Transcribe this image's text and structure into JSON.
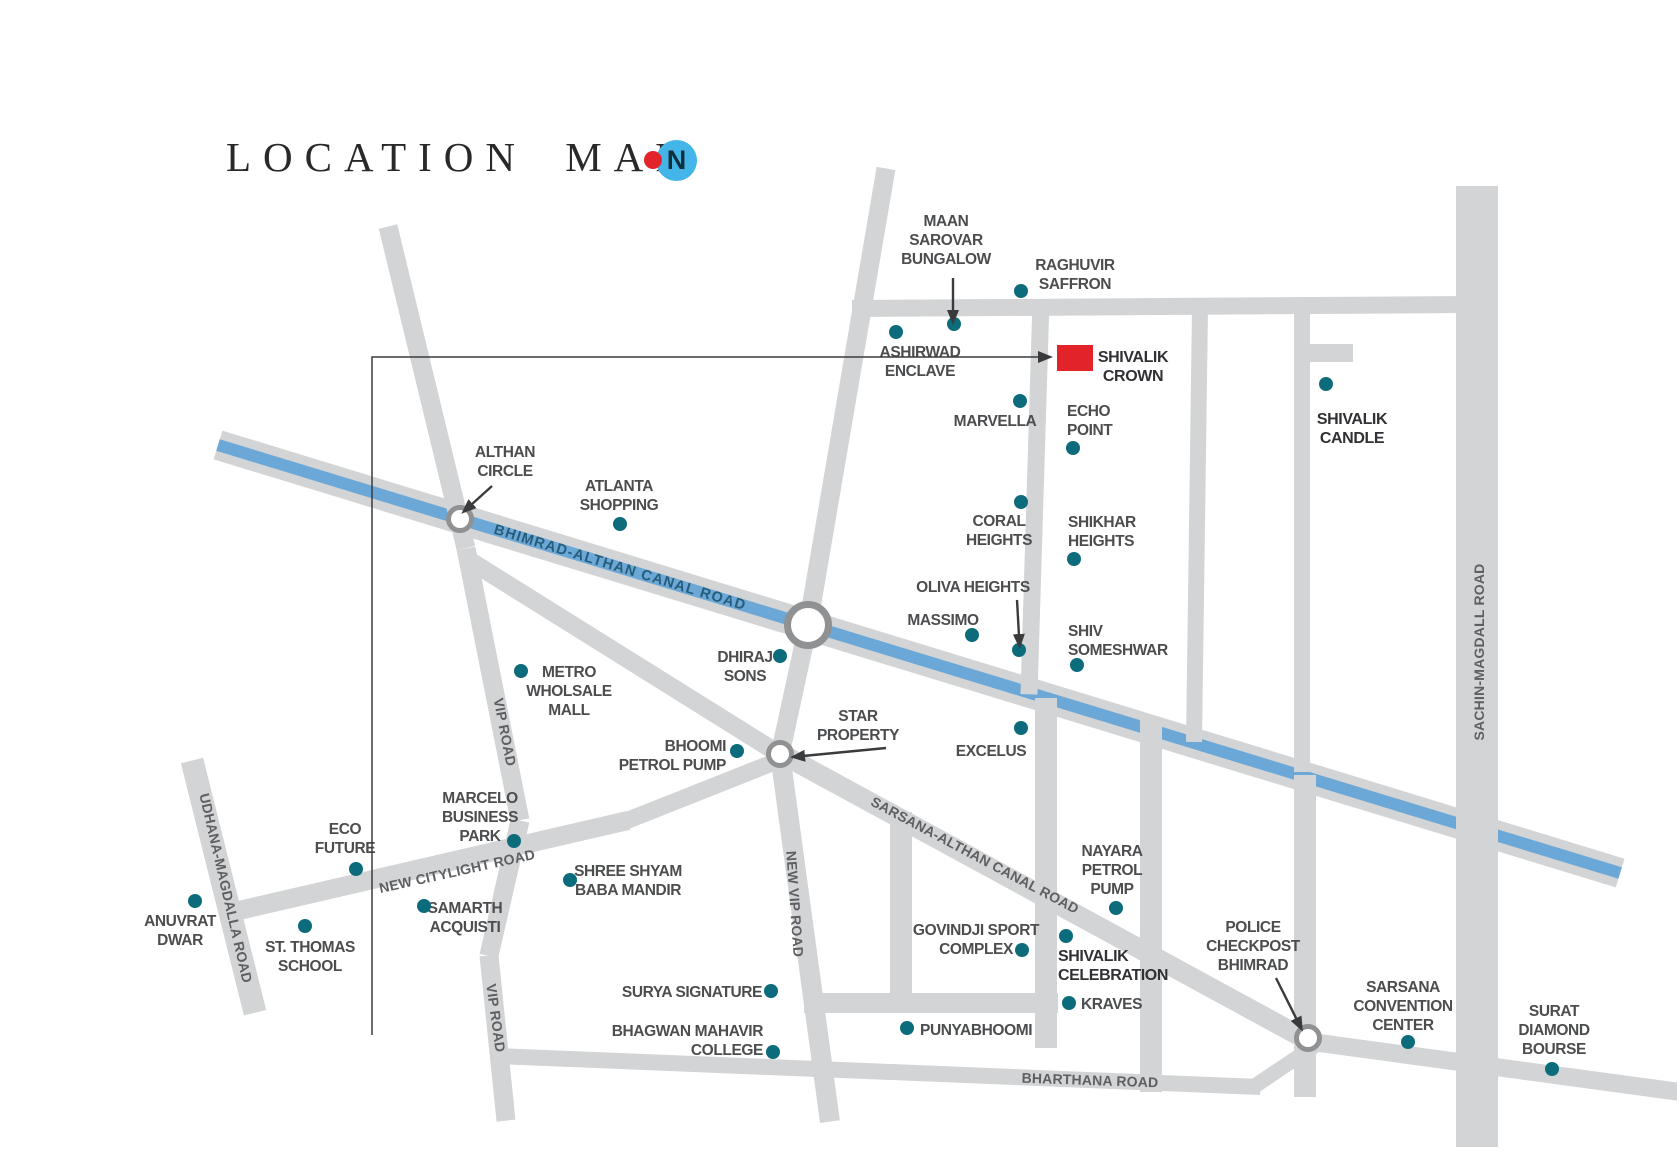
{
  "title": {
    "text": "LOCATION MAP"
  },
  "compass": {
    "letter": "N"
  },
  "colors": {
    "road": "#d3d4d5",
    "canal_blue": "#6ba8d7",
    "ring": "#8f9193",
    "dot": "#0d6c7c",
    "red": "#e3232a",
    "place_text": "#4c4d4f",
    "bold_text": "#303134",
    "road_text": "#5e5f62",
    "canal_text": "#275d7b",
    "arrow": "#3a3b3d",
    "compass_circle": "#44b5e9",
    "compass_letter": "#0e2f3c"
  },
  "map": {
    "canal": {
      "name": "bhimrad-althan-canal",
      "x1": 218,
      "y1": 445,
      "x2": 1620,
      "y2": 873,
      "w": 30
    },
    "roads": [
      {
        "name": "top-road",
        "x1": 852,
        "y1": 308,
        "x2": 1472,
        "y2": 304,
        "w": 17
      },
      {
        "name": "north-approach",
        "x1": 886,
        "y1": 168,
        "x2": 808,
        "y2": 625,
        "w": 19
      },
      {
        "name": "mid-link",
        "x1": 808,
        "y1": 625,
        "x2": 780,
        "y2": 754,
        "w": 19
      },
      {
        "name": "new-vip-road",
        "x1": 780,
        "y1": 754,
        "x2": 830,
        "y2": 1122,
        "w": 20
      },
      {
        "name": "vip-road-upper",
        "x1": 388,
        "y1": 226,
        "x2": 466,
        "y2": 548,
        "w": 19
      },
      {
        "name": "vip-road-mid",
        "x1": 466,
        "y1": 548,
        "x2": 520,
        "y2": 820,
        "w": 19
      },
      {
        "name": "vip-road-lower",
        "x1": 520,
        "y1": 820,
        "x2": 489,
        "y2": 955,
        "w": 19
      },
      {
        "name": "vip-road-end",
        "x1": 489,
        "y1": 955,
        "x2": 506,
        "y2": 1120,
        "w": 19
      },
      {
        "name": "star-branch",
        "x1": 472,
        "y1": 562,
        "x2": 792,
        "y2": 762,
        "w": 18
      },
      {
        "name": "sarsana-althan-canal-road",
        "x1": 778,
        "y1": 752,
        "x2": 1318,
        "y2": 1046,
        "w": 20
      },
      {
        "name": "sarsana-east",
        "x1": 1312,
        "y1": 1042,
        "x2": 1680,
        "y2": 1092,
        "w": 18
      },
      {
        "name": "bharthana-road",
        "x1": 497,
        "y1": 1056,
        "x2": 1260,
        "y2": 1087,
        "w": 16
      },
      {
        "name": "bharthana-link",
        "x1": 1254,
        "y1": 1086,
        "x2": 1318,
        "y2": 1043,
        "w": 15
      },
      {
        "name": "udhana-magdalla-road",
        "x1": 192,
        "y1": 760,
        "x2": 255,
        "y2": 1012,
        "w": 23
      },
      {
        "name": "new-citylight-road",
        "x1": 226,
        "y1": 913,
        "x2": 628,
        "y2": 820,
        "w": 19
      },
      {
        "name": "citylight-ext",
        "x1": 622,
        "y1": 822,
        "x2": 786,
        "y2": 757,
        "w": 17
      },
      {
        "name": "crown-west-road",
        "x1": 1041,
        "y1": 300,
        "x2": 1029,
        "y2": 694,
        "w": 17
      },
      {
        "name": "block-road-2",
        "x1": 1200,
        "y1": 308,
        "x2": 1194,
        "y2": 742,
        "w": 16
      },
      {
        "name": "block-road-3",
        "x1": 1302,
        "y1": 308,
        "x2": 1302,
        "y2": 772,
        "w": 16
      },
      {
        "name": "candle-stub",
        "x1": 1302,
        "y1": 353,
        "x2": 1353,
        "y2": 353,
        "w": 18
      },
      {
        "name": "sachin-magdall-road",
        "x1": 1477,
        "y1": 186,
        "x2": 1477,
        "y2": 1147,
        "w": 42
      },
      {
        "name": "govindji-west",
        "x1": 901,
        "y1": 812,
        "x2": 901,
        "y2": 1006,
        "w": 22
      },
      {
        "name": "celebration-west",
        "x1": 1046,
        "y1": 698,
        "x2": 1046,
        "y2": 1048,
        "w": 22
      },
      {
        "name": "celebration-east",
        "x1": 1151,
        "y1": 720,
        "x2": 1151,
        "y2": 1092,
        "w": 22
      },
      {
        "name": "checkpost-road",
        "x1": 1305,
        "y1": 775,
        "x2": 1305,
        "y2": 1097,
        "w": 22
      },
      {
        "name": "punyabhoomi-road",
        "x1": 804,
        "y1": 1003,
        "x2": 1058,
        "y2": 1003,
        "w": 20
      }
    ],
    "road_labels": [
      {
        "name": "bhimrad-althan-canal-road",
        "text": "BHIMRAD-ALTHAN CANAL ROAD",
        "x": 620,
        "y": 568,
        "rotate": 17,
        "canal": true
      },
      {
        "name": "vip-road-1",
        "text": "VIP ROAD",
        "x": 505,
        "y": 732,
        "rotate": 79
      },
      {
        "name": "vip-road-2",
        "text": "VIP ROAD",
        "x": 496,
        "y": 1018,
        "rotate": 82
      },
      {
        "name": "new-vip-road",
        "text": "NEW VIP ROAD",
        "x": 795,
        "y": 904,
        "rotate": 86
      },
      {
        "name": "udhana-magdalla-road",
        "text": "UDHANA-MAGDALLA ROAD",
        "x": 226,
        "y": 888,
        "rotate": 77
      },
      {
        "name": "new-citylight-road",
        "text": "NEW CITYLIGHT ROAD",
        "x": 457,
        "y": 871,
        "rotate": -12.5
      },
      {
        "name": "sarsana-althan-canal-road",
        "text": "SARSANA-ALTHAN CANAL ROAD",
        "x": 975,
        "y": 855,
        "rotate": 28
      },
      {
        "name": "bharthana-road",
        "text": "BHARTHANA ROAD",
        "x": 1090,
        "y": 1080,
        "rotate": 2
      },
      {
        "name": "sachin-magdall-road",
        "text": "SACHIN-MAGDALL ROAD",
        "x": 1479,
        "y": 652,
        "rotate": -90
      }
    ],
    "roundabouts": [
      {
        "name": "althan-circle",
        "x": 460,
        "y": 519,
        "r": 14,
        "ring": 5
      },
      {
        "name": "canal-junction",
        "x": 808,
        "y": 625,
        "r": 24,
        "ring": 7
      },
      {
        "name": "star-property-junction",
        "x": 780,
        "y": 754,
        "r": 14,
        "ring": 5
      },
      {
        "name": "police-checkpost-junction",
        "x": 1308,
        "y": 1038,
        "r": 14,
        "ring": 5
      }
    ],
    "marker": {
      "name": "shivalik-crown-marker",
      "x": 1057,
      "y": 345,
      "w": 36,
      "h": 26
    },
    "leader": {
      "x": 372,
      "y_top": 357,
      "y_bottom": 1035,
      "x_end": 1040
    },
    "arrows": [
      {
        "name": "maan-sarovar-arrow",
        "x1": 953,
        "y1": 278,
        "x2": 953,
        "y2": 312
      },
      {
        "name": "oliva-heights-arrow",
        "x1": 1017,
        "y1": 600,
        "x2": 1019,
        "y2": 636
      },
      {
        "name": "althan-circle-arrow",
        "x1": 492,
        "y1": 486,
        "x2": 471,
        "y2": 505
      },
      {
        "name": "star-property-arrow",
        "x1": 886,
        "y1": 748,
        "x2": 803,
        "y2": 756
      },
      {
        "name": "police-checkpost-arrow",
        "x1": 1276,
        "y1": 978,
        "x2": 1297,
        "y2": 1020
      }
    ],
    "places": [
      {
        "name": "maan-sarovar-bungalow",
        "lines": [
          "MAAN",
          "SAROVAR",
          "BUNGALOW"
        ],
        "x": 946,
        "y": 212,
        "align": "center",
        "dot": {
          "x": 954,
          "y": 324
        }
      },
      {
        "name": "raghuvir-saffron",
        "lines": [
          "RAGHUVIR",
          "SAFFRON"
        ],
        "x": 1075,
        "y": 256,
        "align": "center",
        "dot": {
          "x": 1021,
          "y": 291
        }
      },
      {
        "name": "ashirwad-enclave",
        "lines": [
          "ASHIRWAD",
          "ENCLAVE"
        ],
        "x": 920,
        "y": 343,
        "align": "center",
        "dot": {
          "x": 896,
          "y": 332
        }
      },
      {
        "name": "shivalik-crown",
        "lines": [
          "SHIVALIK",
          "CROWN"
        ],
        "x": 1133,
        "y": 348,
        "align": "center",
        "bold": true
      },
      {
        "name": "marvella",
        "lines": [
          "MARVELLA"
        ],
        "x": 995,
        "y": 412,
        "align": "center",
        "dot": {
          "x": 1020,
          "y": 401
        }
      },
      {
        "name": "echo-point",
        "lines": [
          "ECHO",
          "POINT"
        ],
        "x": 1067,
        "y": 402,
        "align": "left",
        "dot": {
          "x": 1073,
          "y": 448
        }
      },
      {
        "name": "shivalik-candle",
        "lines": [
          "SHIVALIK",
          "CANDLE"
        ],
        "x": 1352,
        "y": 410,
        "align": "center",
        "bold": true,
        "dot": {
          "x": 1326,
          "y": 384
        }
      },
      {
        "name": "althan-circle",
        "lines": [
          "ALTHAN",
          "CIRCLE"
        ],
        "x": 505,
        "y": 443,
        "align": "center"
      },
      {
        "name": "atlanta-shopping",
        "lines": [
          "ATLANTA",
          "SHOPPING"
        ],
        "x": 619,
        "y": 477,
        "align": "center",
        "dot": {
          "x": 620,
          "y": 524
        }
      },
      {
        "name": "coral-heights",
        "lines": [
          "CORAL",
          "HEIGHTS"
        ],
        "x": 999,
        "y": 512,
        "align": "center",
        "dot": {
          "x": 1021,
          "y": 502
        }
      },
      {
        "name": "shikhar-heights",
        "lines": [
          "SHIKHAR",
          "HEIGHTS"
        ],
        "x": 1068,
        "y": 513,
        "align": "left",
        "dot": {
          "x": 1074,
          "y": 559
        }
      },
      {
        "name": "oliva-heights",
        "lines": [
          "OLIVA HEIGHTS"
        ],
        "x": 973,
        "y": 578,
        "align": "center",
        "dot": {
          "x": 1019,
          "y": 650
        }
      },
      {
        "name": "massimo",
        "lines": [
          "MASSIMO"
        ],
        "x": 943,
        "y": 611,
        "align": "center",
        "dot": {
          "x": 972,
          "y": 635
        }
      },
      {
        "name": "shiv-someshwar",
        "lines": [
          "SHIV",
          "SOMESHWAR"
        ],
        "x": 1068,
        "y": 622,
        "align": "left",
        "dot": {
          "x": 1077,
          "y": 665
        }
      },
      {
        "name": "metro-wholsale-mall",
        "lines": [
          "METRO",
          "WHOLSALE",
          "MALL"
        ],
        "x": 569,
        "y": 663,
        "align": "center",
        "dot": {
          "x": 521,
          "y": 671
        }
      },
      {
        "name": "dhiraj-sons",
        "lines": [
          "DHIRAJ",
          "SONS"
        ],
        "x": 745,
        "y": 648,
        "align": "center",
        "dot": {
          "x": 780,
          "y": 656
        }
      },
      {
        "name": "bhoomi-petrol-pump",
        "lines": [
          "BHOOMI",
          "PETROL PUMP"
        ],
        "x": 726,
        "y": 737,
        "align": "right",
        "dot": {
          "x": 737,
          "y": 751
        }
      },
      {
        "name": "star-property",
        "lines": [
          "STAR",
          "PROPERTY"
        ],
        "x": 858,
        "y": 707,
        "align": "center"
      },
      {
        "name": "excelus",
        "lines": [
          "EXCELUS"
        ],
        "x": 991,
        "y": 742,
        "align": "center",
        "dot": {
          "x": 1021,
          "y": 728
        }
      },
      {
        "name": "eco-future",
        "lines": [
          "ECO",
          "FUTURE"
        ],
        "x": 345,
        "y": 820,
        "align": "center",
        "dot": {
          "x": 356,
          "y": 869
        }
      },
      {
        "name": "marcelo-business-park",
        "lines": [
          "MARCELO",
          "BUSINESS",
          "PARK"
        ],
        "x": 480,
        "y": 789,
        "align": "center",
        "dot": {
          "x": 514,
          "y": 841
        }
      },
      {
        "name": "anuvrat-dwar",
        "lines": [
          "ANUVRAT",
          "DWAR"
        ],
        "x": 180,
        "y": 912,
        "align": "center",
        "dot": {
          "x": 195,
          "y": 901
        }
      },
      {
        "name": "st-thomas-school",
        "lines": [
          "ST. THOMAS",
          "SCHOOL"
        ],
        "x": 310,
        "y": 938,
        "align": "center",
        "dot": {
          "x": 305,
          "y": 926
        }
      },
      {
        "name": "samarth-acquisti",
        "lines": [
          "SAMARTH",
          "ACQUISTI"
        ],
        "x": 465,
        "y": 899,
        "align": "center",
        "dot": {
          "x": 424,
          "y": 906
        }
      },
      {
        "name": "shree-shyam-baba-mandir",
        "lines": [
          "SHREE SHYAM",
          "BABA MANDIR"
        ],
        "x": 628,
        "y": 862,
        "align": "center",
        "dot": {
          "x": 570,
          "y": 880
        }
      },
      {
        "name": "surya-signature",
        "lines": [
          "SURYA SIGNATURE"
        ],
        "x": 762,
        "y": 983,
        "align": "right",
        "dot": {
          "x": 771,
          "y": 991
        }
      },
      {
        "name": "bhagwan-mahavir-college",
        "lines": [
          "BHAGWAN MAHAVIR",
          "COLLEGE"
        ],
        "x": 763,
        "y": 1022,
        "align": "right",
        "dot": {
          "x": 773,
          "y": 1052
        }
      },
      {
        "name": "govindji-sport-complex",
        "lines": [
          "GOVINDJI SPORT",
          "COMPLEX"
        ],
        "x": 976,
        "y": 921,
        "align": "center",
        "dot": {
          "x": 1022,
          "y": 950
        }
      },
      {
        "name": "punyabhoomi",
        "lines": [
          "PUNYABHOOMI"
        ],
        "x": 920,
        "y": 1021,
        "align": "left",
        "dot": {
          "x": 907,
          "y": 1028
        }
      },
      {
        "name": "nayara-petrol-pump",
        "lines": [
          "NAYARA",
          "PETROL",
          "PUMP"
        ],
        "x": 1112,
        "y": 842,
        "align": "center",
        "dot": {
          "x": 1116,
          "y": 908
        }
      },
      {
        "name": "shivalik-celebration",
        "lines": [
          "SHIVALIK",
          "CELEBRATION"
        ],
        "x": 1058,
        "y": 947,
        "align": "left",
        "bold": true,
        "dot": {
          "x": 1066,
          "y": 936
        }
      },
      {
        "name": "kraves",
        "lines": [
          "KRAVES"
        ],
        "x": 1081,
        "y": 995,
        "align": "left",
        "dot": {
          "x": 1069,
          "y": 1003
        }
      },
      {
        "name": "police-checkpost-bhimrad",
        "lines": [
          "POLICE",
          "CHECKPOST",
          "BHIMRAD"
        ],
        "x": 1253,
        "y": 918,
        "align": "center"
      },
      {
        "name": "sarsana-convention-center",
        "lines": [
          "SARSANA",
          "CONVENTION",
          "CENTER"
        ],
        "x": 1403,
        "y": 978,
        "align": "center",
        "dot": {
          "x": 1408,
          "y": 1042
        }
      },
      {
        "name": "surat-diamond-bourse",
        "lines": [
          "SURAT",
          "DIAMOND",
          "BOURSE"
        ],
        "x": 1554,
        "y": 1002,
        "align": "center",
        "dot": {
          "x": 1552,
          "y": 1069
        }
      }
    ]
  }
}
